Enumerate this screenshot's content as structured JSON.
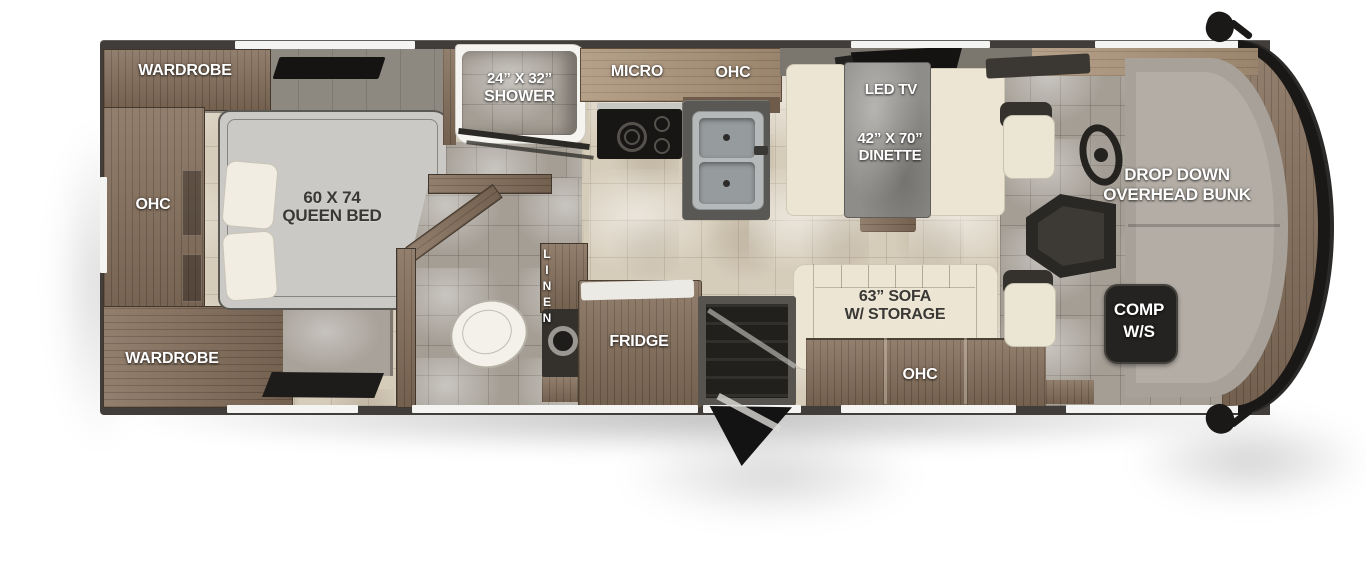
{
  "labels": {
    "wardrobe_top": "WARDROBE",
    "ohc_bedroom": "OHC",
    "bed_size": "60 X 74",
    "bed_name": "QUEEN BED",
    "wardrobe_bottom": "WARDROBE",
    "shower_size": "24” X 32”",
    "shower_name": "SHOWER",
    "micro": "MICRO",
    "ohc_kitchen": "OHC",
    "linen": "LINEN",
    "fridge": "FRIDGE",
    "led_tv": "LED TV",
    "dinette_size": "42” X 70”",
    "dinette_name": "DINETTE",
    "sofa_size": "63” SOFA",
    "sofa_storage": "W/ STORAGE",
    "ohc_sofa": "OHC",
    "bunk_line1": "DROP DOWN",
    "bunk_line2": "OVERHEAD BUNK",
    "comp_line1": "COMP",
    "comp_line2": "W/S"
  },
  "colors": {
    "wall": "#403d3a",
    "wood": "#86705c",
    "wood_light": "#ab9379",
    "floor_beige": "#d6ccba",
    "floor_gray": "#a49e95",
    "cream_upholstery": "#ece5d3",
    "mattress": "#cac9c5",
    "front_cap": "#191817",
    "dash_gray": "#a7a199",
    "label_white": "#ffffff",
    "label_dark": "#3a3835"
  }
}
